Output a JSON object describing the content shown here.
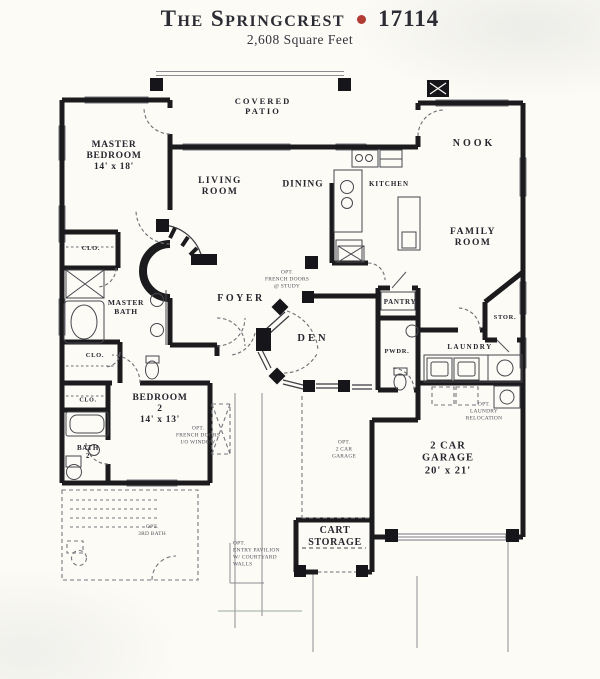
{
  "header": {
    "title": "The Springcrest",
    "plan_number": "17114",
    "subtitle": "2,608 Square Feet"
  },
  "rooms": {
    "covered_patio": "COVERED\nPATIO",
    "master_bedroom": "MASTER\nBEDROOM\n14' x 18'",
    "living_room": "LIVING\nROOM",
    "dining": "DINING",
    "kitchen": "KITCHEN",
    "nook": "NOOK",
    "family_room": "FAMILY\nROOM",
    "closet_master_1": "CLO.",
    "master_bath": "MASTER\nBATH",
    "closet_master_2": "CLO.",
    "foyer": "FOYER",
    "den": "DEN",
    "pantry": "PANTRY",
    "powder": "PWDR.",
    "storage": "STOR.",
    "laundry": "LAUNDRY",
    "closet_bedroom2": "CLO.",
    "bedroom_2": "BEDROOM\n2\n14' x 13'",
    "bath_2": "BATH\n2",
    "garage": "2 CAR\nGARAGE\n20' x 21'",
    "cart_storage": "CART\nSTORAGE"
  },
  "options": {
    "french_doors_study": "OPT.\nFRENCH DOORS\n@ STUDY",
    "french_doors_window": "OPT.\nFRENCH DOORS\nI/O WINDOW",
    "laundry_relocation": "OPT.\nLAUNDRY\nRELOCATION",
    "second_garage": "OPT.\n2 CAR\nGARAGE",
    "entry_pavilion": "OPT.\nENTRY PAVILION\nW/ COURTYARD\nWALLS",
    "third_bath": "OPT.\n3RD BATH"
  },
  "colors": {
    "bullet": "#b23b33",
    "wall": "#1b1b1e",
    "paper": "#fcfbf6"
  }
}
